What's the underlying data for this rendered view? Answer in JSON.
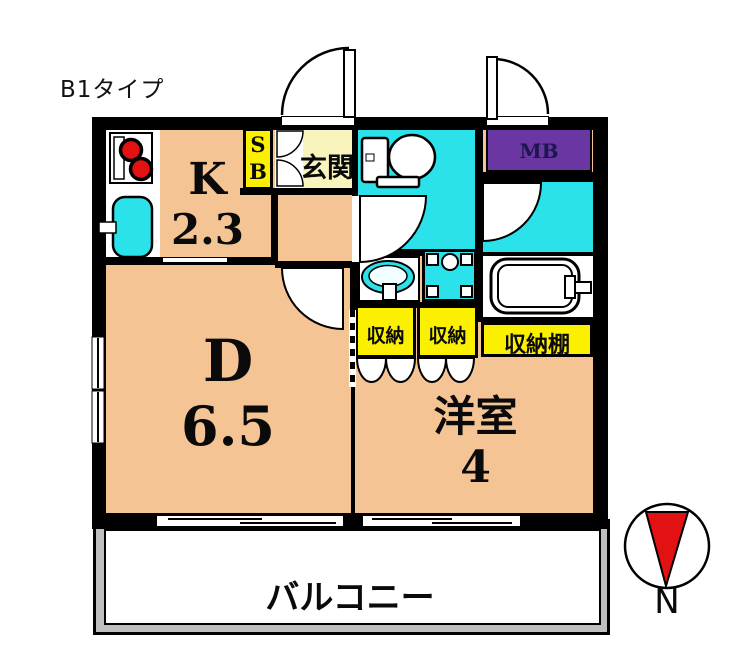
{
  "title": "B1タイプ",
  "plan": {
    "kitchen": {
      "label": "K",
      "size": "2.3"
    },
    "dining": {
      "label": "D",
      "size": "6.5"
    },
    "western_room": {
      "label": "洋室",
      "size": "4"
    },
    "entrance": {
      "label": "玄関"
    },
    "shoe_box": {
      "line1": "S",
      "line2": "B"
    },
    "meter_box": {
      "label": "MB"
    },
    "storage_left": {
      "label": "収納"
    },
    "storage_right": {
      "label": "収納"
    },
    "storage_shelf": {
      "label": "収納棚"
    },
    "balcony": {
      "label": "バルコニー"
    },
    "compass": {
      "north_label": "N"
    }
  },
  "colors": {
    "room_orange": "#F5C494",
    "water_cyan": "#2BE2EA",
    "storage_yellow": "#FBF000",
    "entrance_yellow": "#F9F3BC",
    "meterbox_purple": "#6936A2",
    "meterbox_text": "#1E1650",
    "compass_red": "#E31212",
    "balcony_gray": "#BFBFBF",
    "wall_black": "#000000"
  }
}
